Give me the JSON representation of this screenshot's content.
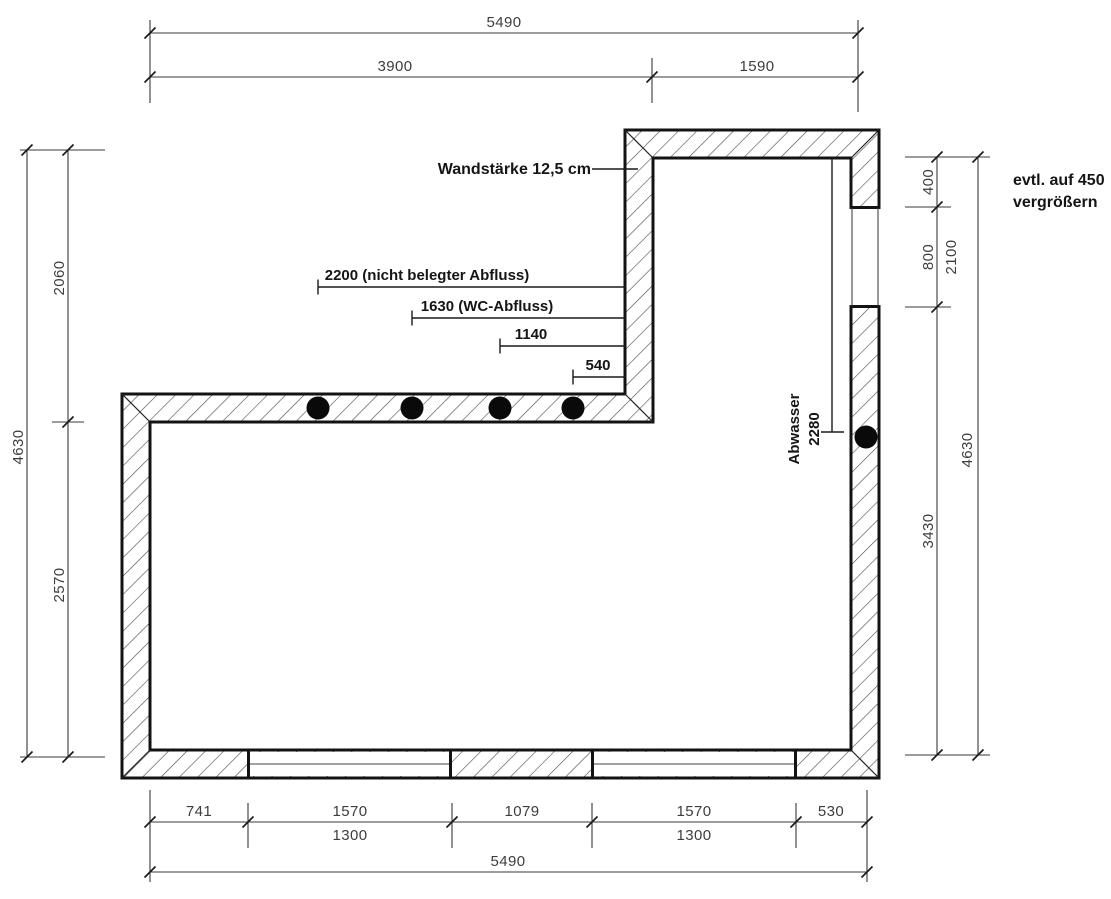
{
  "drawing": {
    "wall_note": "Wandstärke 12,5 cm",
    "note_line1": "evtl. auf 450",
    "note_line2": "vergrößern",
    "abwasser_label": "Abwasser",
    "abwasser_value": "2280",
    "leaders": {
      "l2200": "2200 (nicht belegter Abfluss)",
      "l1630": "1630 (WC-Abfluss)",
      "l1140": "1140",
      "l540": "540"
    },
    "dims": {
      "top": {
        "overall": "5490",
        "left": "3900",
        "right": "1590"
      },
      "left": {
        "overall": "4630",
        "upper": "2060",
        "lower": "2570"
      },
      "right": {
        "above_window": "400",
        "window": "800",
        "window_total": "2100",
        "below_window": "3430",
        "overall": "4630"
      },
      "bottom": {
        "row1": [
          "741",
          "1570",
          "1079",
          "1570",
          "530"
        ],
        "row2": [
          "1300",
          "1300"
        ],
        "overall": "5490"
      }
    }
  }
}
